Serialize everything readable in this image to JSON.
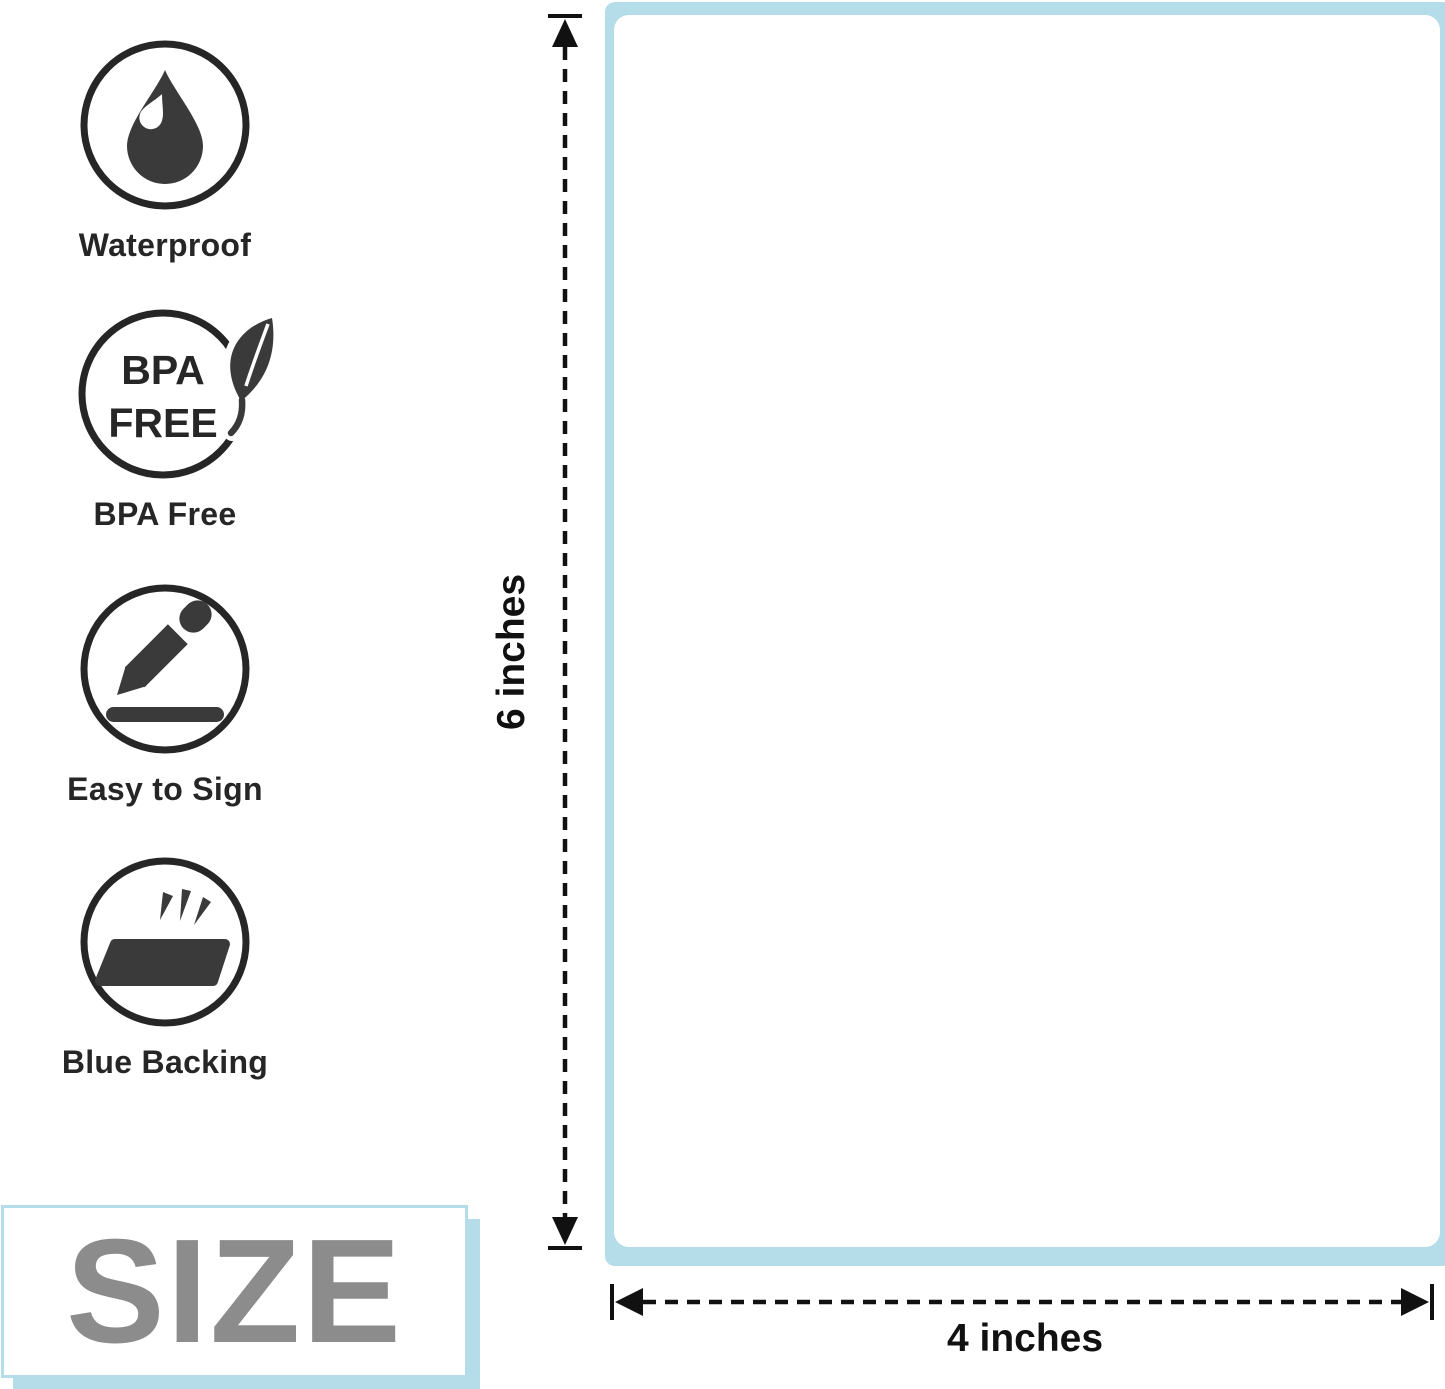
{
  "features": [
    {
      "icon": "water-drop-icon",
      "label": "Waterproof"
    },
    {
      "icon": "bpa-free-icon",
      "label": "BPA Free",
      "badge_line1": "BPA",
      "badge_line2": "FREE"
    },
    {
      "icon": "pen-sign-icon",
      "label": "Easy to Sign"
    },
    {
      "icon": "label-backing-icon",
      "label": "Blue Backing"
    }
  ],
  "label_preview": {
    "height_label": "6 inches",
    "width_label": "4 inches"
  },
  "size_badge": {
    "label": "SIZE"
  },
  "colors": {
    "accent_blue": "#b4dde9",
    "icon_dark": "#262626",
    "icon_fill": "#3a3a3a",
    "size_gray": "#8c8c8c",
    "dimension_black": "#111111"
  }
}
